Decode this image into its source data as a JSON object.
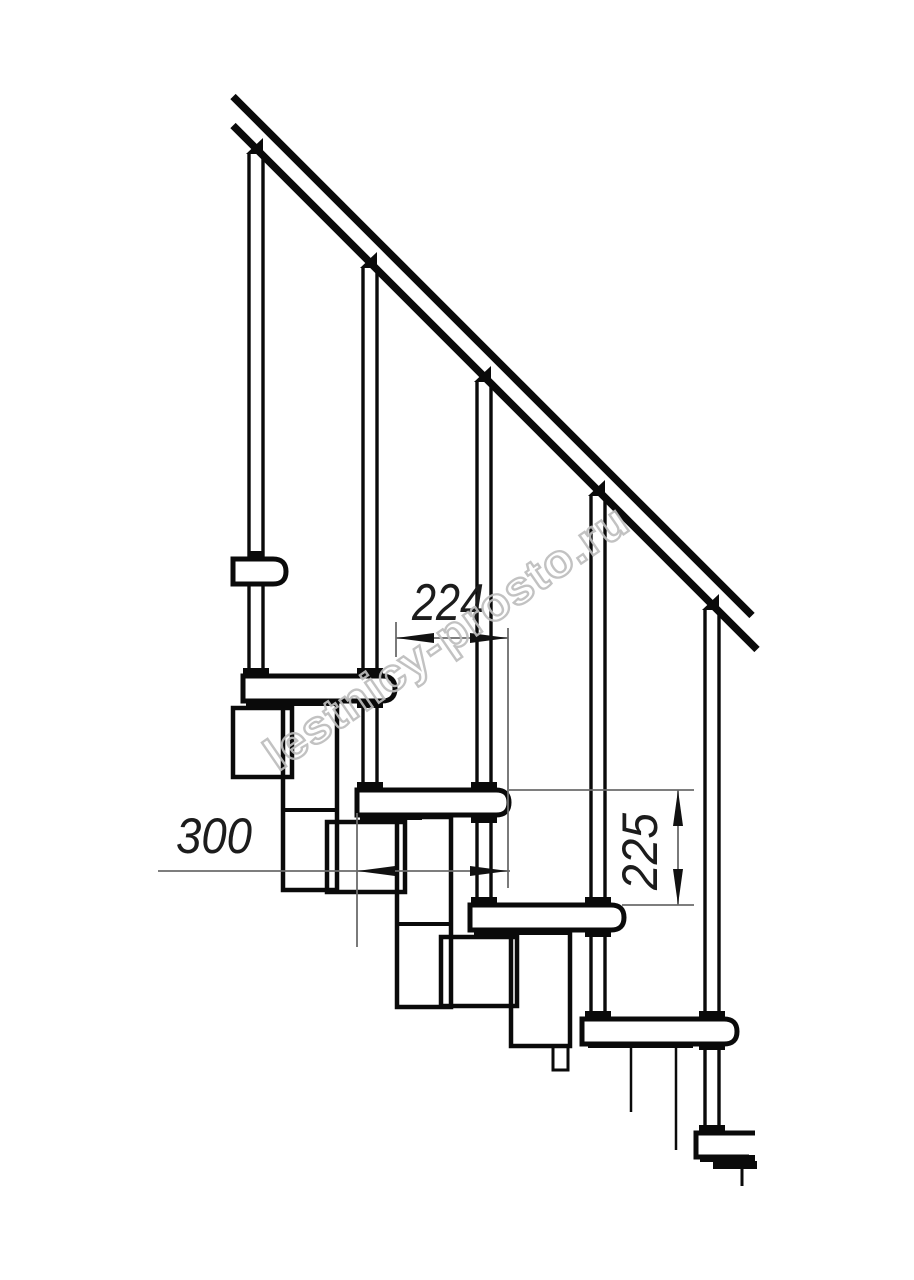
{
  "drawing": {
    "kind": "staircase-side-elevation",
    "background": "#ffffff",
    "line_color": "#0a0a0a",
    "dim_line_color": "#6b6b6b"
  },
  "dimensions": {
    "step_run": {
      "value": "224"
    },
    "tread_length": {
      "value": "300"
    },
    "step_rise": {
      "value": "225"
    }
  },
  "watermark": {
    "text": "lestnicy-prosto.ru",
    "color": "#bdbdbd"
  }
}
